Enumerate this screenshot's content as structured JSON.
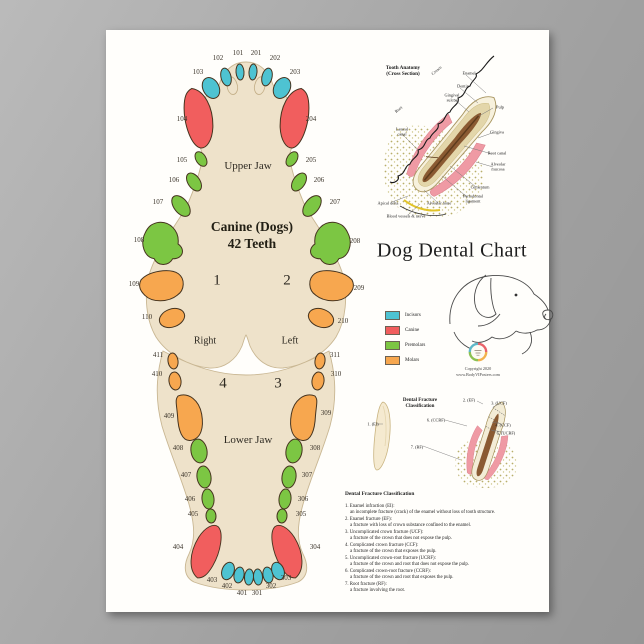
{
  "poster": {
    "title": "Dog Dental Chart",
    "jaw": {
      "title_line1": "Canine (Dogs)",
      "title_line2": "42 Teeth",
      "upper_label": "Upper Jaw",
      "lower_label": "Lower Jaw",
      "right_label": "Right",
      "left_label": "Left",
      "quadrants": {
        "q1": "1",
        "q2": "2",
        "q3": "3",
        "q4": "4"
      }
    },
    "teeth": [
      {
        "num": "101",
        "type": "incisor"
      },
      {
        "num": "201",
        "type": "incisor"
      },
      {
        "num": "102",
        "type": "incisor"
      },
      {
        "num": "202",
        "type": "incisor"
      },
      {
        "num": "103",
        "type": "incisor"
      },
      {
        "num": "203",
        "type": "incisor"
      },
      {
        "num": "104",
        "type": "canine"
      },
      {
        "num": "204",
        "type": "canine"
      },
      {
        "num": "105",
        "type": "premolar"
      },
      {
        "num": "205",
        "type": "premolar"
      },
      {
        "num": "106",
        "type": "premolar"
      },
      {
        "num": "206",
        "type": "premolar"
      },
      {
        "num": "107",
        "type": "premolar"
      },
      {
        "num": "207",
        "type": "premolar"
      },
      {
        "num": "108",
        "type": "premolar"
      },
      {
        "num": "208",
        "type": "premolar"
      },
      {
        "num": "109",
        "type": "molar"
      },
      {
        "num": "209",
        "type": "molar"
      },
      {
        "num": "110",
        "type": "molar"
      },
      {
        "num": "210",
        "type": "molar"
      },
      {
        "num": "411",
        "type": "molar"
      },
      {
        "num": "311",
        "type": "molar"
      },
      {
        "num": "410",
        "type": "molar"
      },
      {
        "num": "310",
        "type": "molar"
      },
      {
        "num": "409",
        "type": "molar"
      },
      {
        "num": "309",
        "type": "molar"
      },
      {
        "num": "408",
        "type": "premolar"
      },
      {
        "num": "308",
        "type": "premolar"
      },
      {
        "num": "407",
        "type": "premolar"
      },
      {
        "num": "307",
        "type": "premolar"
      },
      {
        "num": "406",
        "type": "premolar"
      },
      {
        "num": "306",
        "type": "premolar"
      },
      {
        "num": "405",
        "type": "premolar"
      },
      {
        "num": "305",
        "type": "premolar"
      },
      {
        "num": "404",
        "type": "canine"
      },
      {
        "num": "304",
        "type": "canine"
      },
      {
        "num": "403",
        "type": "incisor"
      },
      {
        "num": "402",
        "type": "incisor"
      },
      {
        "num": "401",
        "type": "incisor"
      },
      {
        "num": "301",
        "type": "incisor"
      },
      {
        "num": "302",
        "type": "incisor"
      },
      {
        "num": "303",
        "type": "incisor"
      }
    ],
    "colors": {
      "incisor": "#4ec3d2",
      "canine": "#f15e5e",
      "premolar": "#7cc643",
      "molar": "#f7a74f",
      "jaw_fill": "#eee2ca",
      "tooth_outline": "#46341f"
    },
    "anatomy": {
      "heading_line1": "Tooth Anatomy",
      "heading_line2": "(Cross Section)",
      "labels": [
        "Crown",
        "Root",
        "Enamel",
        "Dentin",
        "Gingival sulcus",
        "Pulp",
        "Gingiva",
        "Lateral canal",
        "Root canal",
        "Alveolar mucosa",
        "Cementum",
        "Periodontal ligament",
        "Alveolar bone",
        "Apical delta",
        "Blood vessels & nerve"
      ]
    },
    "legend": {
      "items": [
        {
          "label": "Incisors",
          "color": "#4ec3d2"
        },
        {
          "label": "Canine",
          "color": "#f15e5e"
        },
        {
          "label": "Premolars",
          "color": "#7cc643"
        },
        {
          "label": "Molars",
          "color": "#f7a74f"
        }
      ]
    },
    "fracture_diagram": {
      "heading": "Dental Fracture Classification",
      "labels": [
        "1. (EI)",
        "2. (EF)",
        "3. (UCF)",
        "4. (CCF)",
        "5. (UCRF)",
        "6. (CCRF)",
        "7. (RF)"
      ]
    },
    "fracture_text": {
      "heading": "Dental Fracture Classification",
      "items": [
        {
          "term": "1. Enamel infraction (EI):",
          "desc": "an incomplete fracture (crack) of the enamel without loss of tooth structure."
        },
        {
          "term": "2. Enamel fracture (EF):",
          "desc": "a fracture with loss of crown substance confined to the enamel."
        },
        {
          "term": "3. Uncomplicated crown fracture (UCF):",
          "desc": "a fracture of the crown that does not expose the pulp."
        },
        {
          "term": "4. Complicated crown fracture (CCF):",
          "desc": "a fracture of the crown that exposes the pulp."
        },
        {
          "term": "5. Uncomplicated crown-root fracture (UCRF):",
          "desc": "a fracture of the crown and root that does not expose the pulp."
        },
        {
          "term": "6. Complicated crown-root fracture (CCRF):",
          "desc": "a fracture of the crown and root that exposes the pulp."
        },
        {
          "term": "7. Root fracture (RF):",
          "desc": "a fracture involving the root."
        }
      ]
    },
    "footer": {
      "copyright": "Copyright 2020",
      "website": "www.BodyVIPosters.com"
    }
  }
}
